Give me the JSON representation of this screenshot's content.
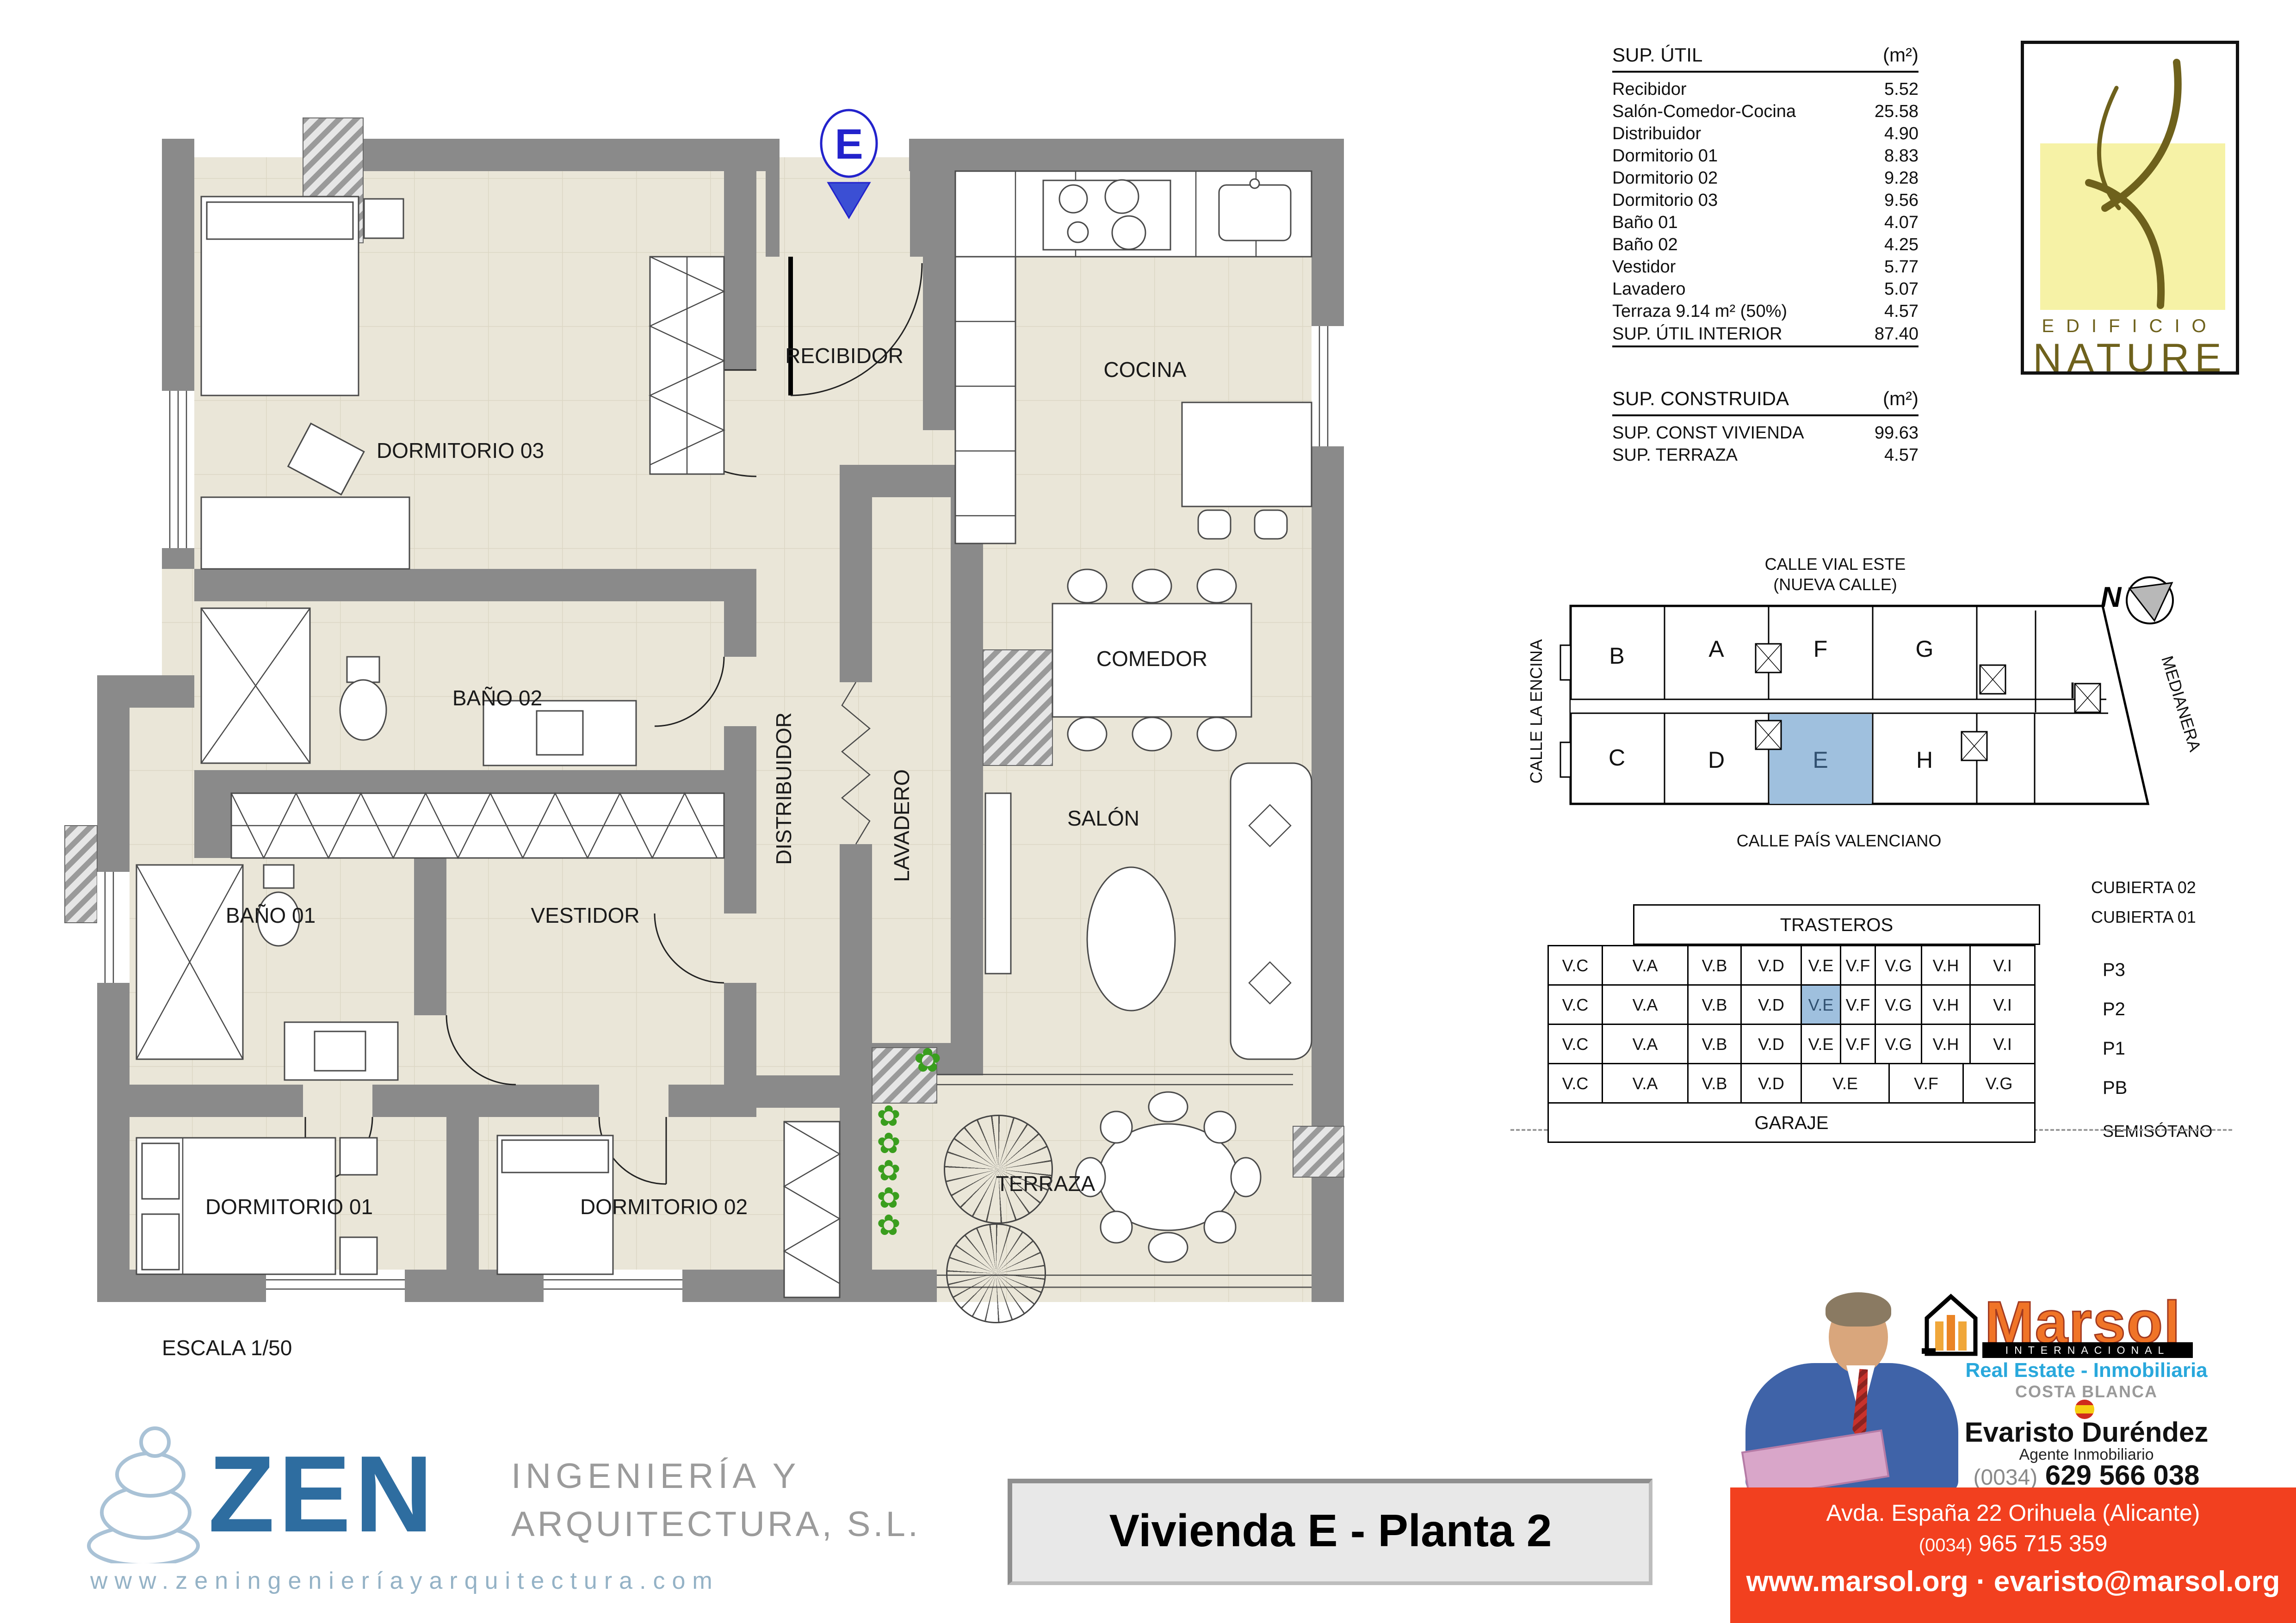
{
  "icons": {
    "plant": "✿"
  },
  "floor_plan": {
    "entrance_label": "E",
    "scale_label": "ESCALA 1/50",
    "rooms": {
      "recibidor": "RECIBIDOR",
      "cocina": "COCINA",
      "dormitorio03": "DORMITORIO 03",
      "bano02": "BAÑO 02",
      "comedor": "COMEDOR",
      "salon": "SALÓN",
      "distribuidor": "DISTRIBUIDOR",
      "lavadero": "LAVADERO",
      "bano01": "BAÑO 01",
      "vestidor": "VESTIDOR",
      "dormitorio01": "DORMITORIO 01",
      "dormitorio02": "DORMITORIO 02",
      "terraza": "TERRAZA"
    }
  },
  "sup_util": {
    "title": "SUP. ÚTIL",
    "unit": "(m²)",
    "rows": [
      {
        "label": "Recibidor",
        "value": "5.52"
      },
      {
        "label": "Salón-Comedor-Cocina",
        "value": "25.58"
      },
      {
        "label": "Distribuidor",
        "value": "4.90"
      },
      {
        "label": "Dormitorio 01",
        "value": "8.83"
      },
      {
        "label": "Dormitorio 02",
        "value": "9.28"
      },
      {
        "label": "Dormitorio 03",
        "value": "9.56"
      },
      {
        "label": "Baño 01",
        "value": "4.07"
      },
      {
        "label": "Baño 02",
        "value": "4.25"
      },
      {
        "label": "Vestidor",
        "value": "5.77"
      },
      {
        "label": "Lavadero",
        "value": "5.07"
      },
      {
        "label": "Terraza 9.14 m² (50%)",
        "value": "4.57"
      }
    ],
    "total_label": "SUP. ÚTIL INTERIOR",
    "total_value": "87.40"
  },
  "sup_construida": {
    "title": "SUP. CONSTRUIDA",
    "unit": "(m²)",
    "rows": [
      {
        "label": "SUP. CONST VIVIENDA",
        "value": "99.63"
      },
      {
        "label": "SUP. TERRAZA",
        "value": "4.57"
      }
    ]
  },
  "nature": {
    "line1": "EDIFICIO",
    "line2": "NATURE"
  },
  "site_plan": {
    "street_top_1": "CALLE VIAL ESTE",
    "street_top_2": "(NUEVA CALLE)",
    "street_left": "CALLE LA ENCINA",
    "street_right": "MEDIANERA",
    "street_bottom": "CALLE PAÍS VALENCIANO",
    "north": "N",
    "units": {
      "a": "A",
      "b": "B",
      "c": "C",
      "d": "D",
      "e": "E",
      "f": "F",
      "g": "G",
      "h": "H",
      "i": "I"
    }
  },
  "stack": {
    "trasteros": "TRASTEROS",
    "cubierta2": "CUBIERTA 02",
    "cubierta1": "CUBIERTA 01",
    "garaje": "GARAJE",
    "semisotano": "SEMISÓTANO",
    "p3": {
      "label": "P3",
      "cells": [
        "V.C",
        "V.A",
        "V.B",
        "V.D",
        "V.E",
        "V.F",
        "V.G",
        "V.H",
        "V.I"
      ]
    },
    "p2": {
      "label": "P2",
      "cells": [
        "V.C",
        "V.A",
        "V.B",
        "V.D",
        "V.E",
        "V.F",
        "V.G",
        "V.H",
        "V.I"
      ]
    },
    "p1": {
      "label": "P1",
      "cells": [
        "V.C",
        "V.A",
        "V.B",
        "V.D",
        "V.E",
        "V.F",
        "V.G",
        "V.H",
        "V.I"
      ]
    },
    "pb": {
      "label": "PB",
      "cells": [
        "V.C",
        "V.A",
        "V.B",
        "V.D",
        "V.E",
        "V.F",
        "V.G"
      ]
    }
  },
  "marsol": {
    "brand": "Marsol",
    "brand_bar": "INTERNACIONAL",
    "tagline": "Real Estate - Inmobiliaria",
    "region": "COSTA BLANCA",
    "agent": "Evaristo Duréndez",
    "role": "Agente Inmobiliario",
    "phone_prefix": "(0034)",
    "phone": "629 566 038",
    "address": "Avda. España 22 Orihuela (Alicante)",
    "phone2_prefix": "(0034)",
    "phone2": "965 715 359",
    "web": "www.marsol.org · evaristo@marsol.org"
  },
  "zen": {
    "brand": "ZEN",
    "line1": "INGENIERÍA Y",
    "line2": "ARQUITECTURA, S.L.",
    "web": "www.zeningenieríayarquitectura.com"
  },
  "title_block": {
    "title": "Vivienda E - Planta 2"
  },
  "colors": {
    "accent_blue": "#9fc0de",
    "wall_gray": "#8a8a8a",
    "floor_beige": "#eae6d8",
    "marsol_orange": "#f07427",
    "banner_red": "#f2401f",
    "zen_blue": "#2e6da0",
    "nature_olive": "#6e611c",
    "nature_yellow": "#f6f2a6",
    "entrance_blue": "#2323cc"
  }
}
